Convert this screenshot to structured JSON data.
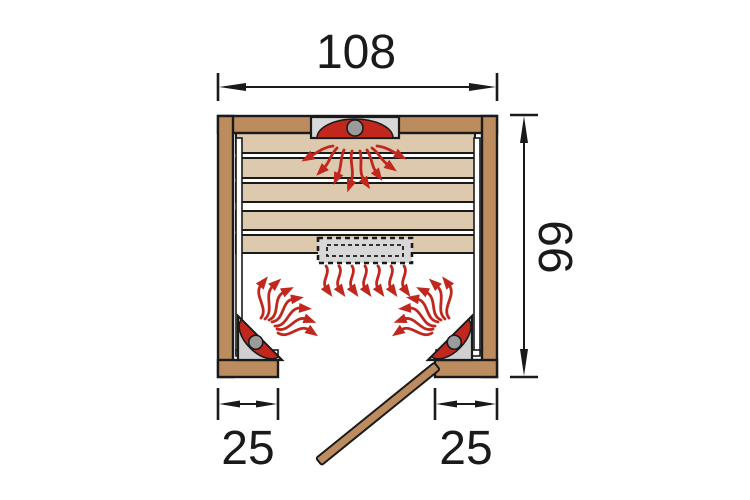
{
  "diagram": {
    "name": "infrared-sauna-floor-plan-top-view",
    "dimensions": {
      "width_label": "108",
      "depth_label": "99",
      "left_segment_label": "25",
      "right_segment_label": "25"
    },
    "colors": {
      "wood": "#bd8c5e",
      "wood_light": "#ddc9ae",
      "heat_red": "#c1271d",
      "panel_gray": "#d8d8d8",
      "knob_gray": "#9b9b9b",
      "outline": "#1a1a1a",
      "bg": "#ffffff"
    }
  }
}
